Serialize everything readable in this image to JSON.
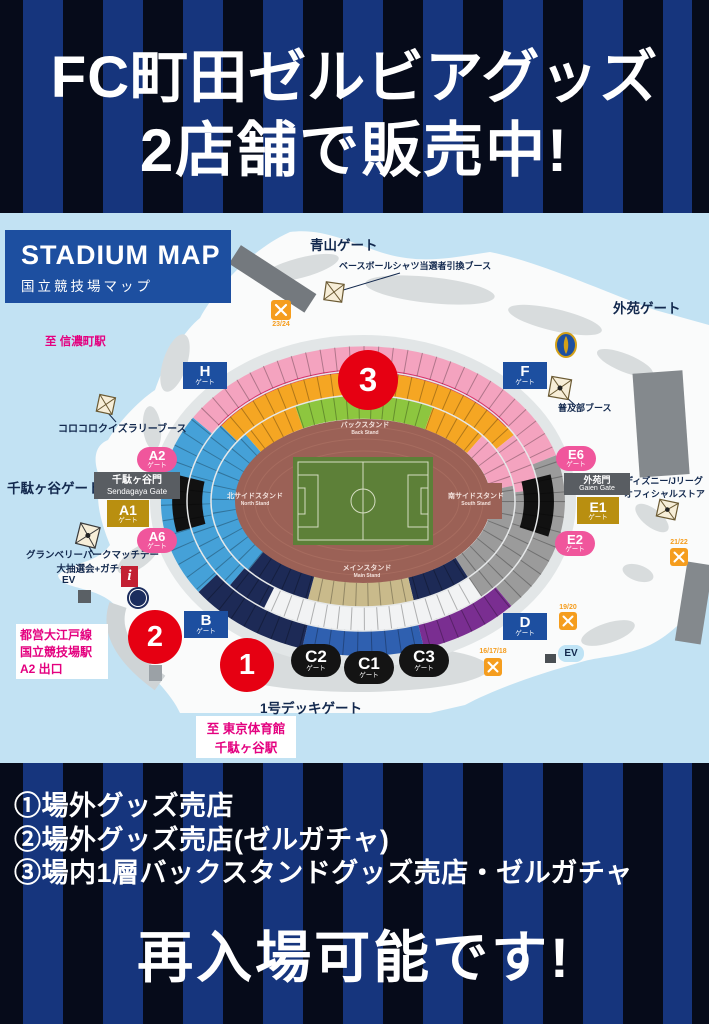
{
  "colors": {
    "stripe_dark": "#060b1a",
    "stripe_blue": "#16357d",
    "map_background": "#c2e2f3",
    "panel_blue": "#1d4fa0",
    "marker_red": "#e60012",
    "station_magenta": "#e4007f",
    "label_navy": "#13294e",
    "gate_pink": "#f0569c",
    "gate_gold": "#b98f10",
    "pitch_green": "#5d8038",
    "track_maroon": "#9b6156"
  },
  "header": {
    "title_line1": "FC町田ゼルビアグッズ",
    "title_line2": "2店舗で販売中!"
  },
  "map": {
    "panel": {
      "title": "STADIUM MAP",
      "subtitle": "国立競技場マップ"
    },
    "area_labels": {
      "aoyama": "青山ゲート",
      "gaien": "外苑ゲート",
      "sendagaya": "千駄ヶ谷ゲート",
      "shinanomachi": "至 信濃町駅",
      "tokyo_gym_1": "至 東京体育館",
      "tokyo_gym_2": "千駄ヶ谷駅",
      "oedo_1": "都営大江戸線",
      "oedo_2": "国立競技場駅",
      "oedo_3": "A2 出口",
      "deck": "1号デッキゲート"
    },
    "booths": {
      "baseball": "ベースボールシャツ当選者引換ブース",
      "fukyubu": "普及部ブース",
      "korokoro": "コロコロクイズラリーブース",
      "granberry_1": "グランベリーパークマッチデー",
      "granberry_2": "大抽選会+ガチャ",
      "disney_1": "ディズニー/Jリーグ",
      "disney_2": "オフィシャルストア"
    },
    "named_gates": {
      "sendagaya_jp": "千駄ヶ谷門",
      "sendagaya_en": "Sendagaya Gate",
      "gaien_jp": "外苑門",
      "gaien_en": "Gaien Gate"
    },
    "gates": {
      "h": {
        "label": "H",
        "sub": "ゲート"
      },
      "f": {
        "label": "F",
        "sub": "ゲート"
      },
      "b": {
        "label": "B",
        "sub": "ゲート"
      },
      "d": {
        "label": "D",
        "sub": "ゲート"
      },
      "a1": {
        "label": "A1",
        "sub": "ゲート"
      },
      "a2": {
        "label": "A2",
        "sub": "ゲート"
      },
      "a6": {
        "label": "A6",
        "sub": "ゲート"
      },
      "e1": {
        "label": "E1",
        "sub": "ゲート"
      },
      "e2": {
        "label": "E2",
        "sub": "ゲート"
      },
      "e6": {
        "label": "E6",
        "sub": "ゲート"
      },
      "c1": {
        "label": "C1",
        "sub": "ゲート"
      },
      "c2": {
        "label": "C2",
        "sub": "ゲート"
      },
      "c3": {
        "label": "C3",
        "sub": "ゲート"
      }
    },
    "stands": {
      "back_jp": "バックスタンド",
      "back_en": "Back Stand",
      "north_jp": "北サイドスタンド",
      "north_en": "North Stand",
      "south_jp": "南サイドスタンド",
      "south_en": "South Stand",
      "main_jp": "メインスタンド",
      "main_en": "Main Stand"
    },
    "markers": {
      "m1": "1",
      "m2": "2",
      "m3": "3"
    },
    "misc": {
      "ev_left": "EV",
      "ev_right": "EV",
      "info": "i",
      "food_23_24": "23/24",
      "food_21_22": "21/22",
      "food_19_20": "19/20",
      "food_16_18": "16/17/18"
    }
  },
  "footer": {
    "items": [
      "①場外グッズ売店",
      "②場外グッズ売店(ゼルガチャ)",
      "③場内1層バックスタンドグッズ売店・ゼルガチャ"
    ],
    "big_text": "再入場可能です!"
  }
}
